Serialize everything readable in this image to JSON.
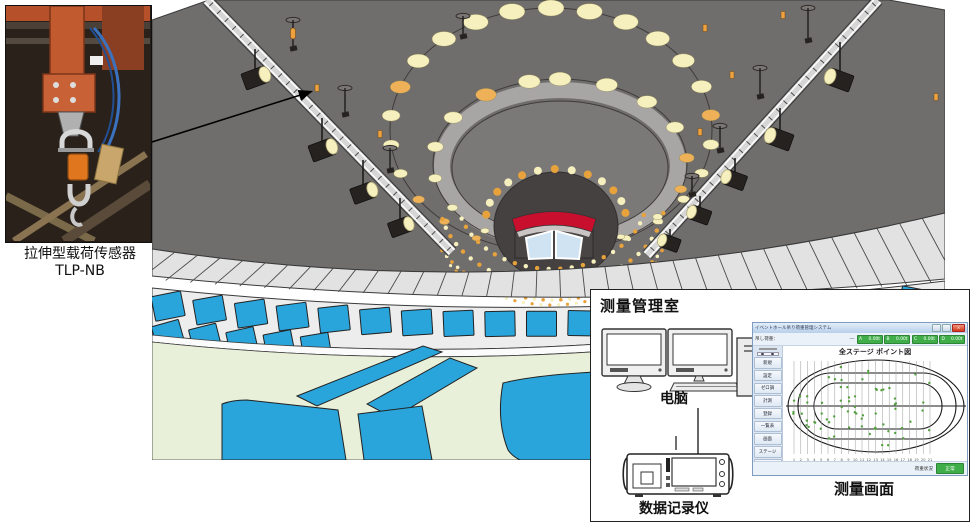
{
  "photo": {
    "caption_line1": "拉伸型载荷传感器",
    "caption_line2": "TLP-NB"
  },
  "room": {
    "title": "测量管理室",
    "computer_label": "电脑",
    "recorder_label": "数据记录仪",
    "screen_label": "测量画面"
  },
  "software": {
    "window_title": "イベントホール吊り荷重管理システム",
    "load_label": "吊し荷重：",
    "load_dash": "—",
    "close_glyph": "×",
    "channels": [
      {
        "name": "A",
        "value": "0.00t"
      },
      {
        "name": "B",
        "value": "0.00t"
      },
      {
        "name": "C",
        "value": "0.00t"
      },
      {
        "name": "D",
        "value": "0.00t"
      }
    ],
    "plot_title": "全ステージ ポイント図",
    "sidebar_buttons": [
      "新規",
      "設定",
      "ゼロ調",
      "計測",
      "登録",
      "一覧表",
      "画面",
      "ステージ",
      "終了"
    ],
    "x_labels": [
      "1",
      "2",
      "3",
      "4",
      "5",
      "6",
      "7",
      "8",
      "9",
      "10",
      "11",
      "12",
      "13",
      "14",
      "15",
      "16",
      "17",
      "18",
      "19",
      "20",
      "21"
    ],
    "status_label": "荷重状況",
    "status_button": "正常"
  },
  "colors": {
    "ceiling_gray": "#706d6d",
    "ring_band_gray": "#a8a5a5",
    "inner_gray": "#7b7878",
    "dome_dark": "#464141",
    "light_cream": "#f6efbe",
    "light_orange": "#efb158",
    "sensor_orange": "#eda23f",
    "red_band": "#c8102e",
    "window_blue": "#cfe3f3",
    "seat_blue": "#29a5dc",
    "floor_green": "#e9f0da",
    "stripe_gray": "#e2e2e2",
    "tier_gray": "#ededed",
    "dot_green": "#55a040",
    "button_green": "#3fae49"
  }
}
